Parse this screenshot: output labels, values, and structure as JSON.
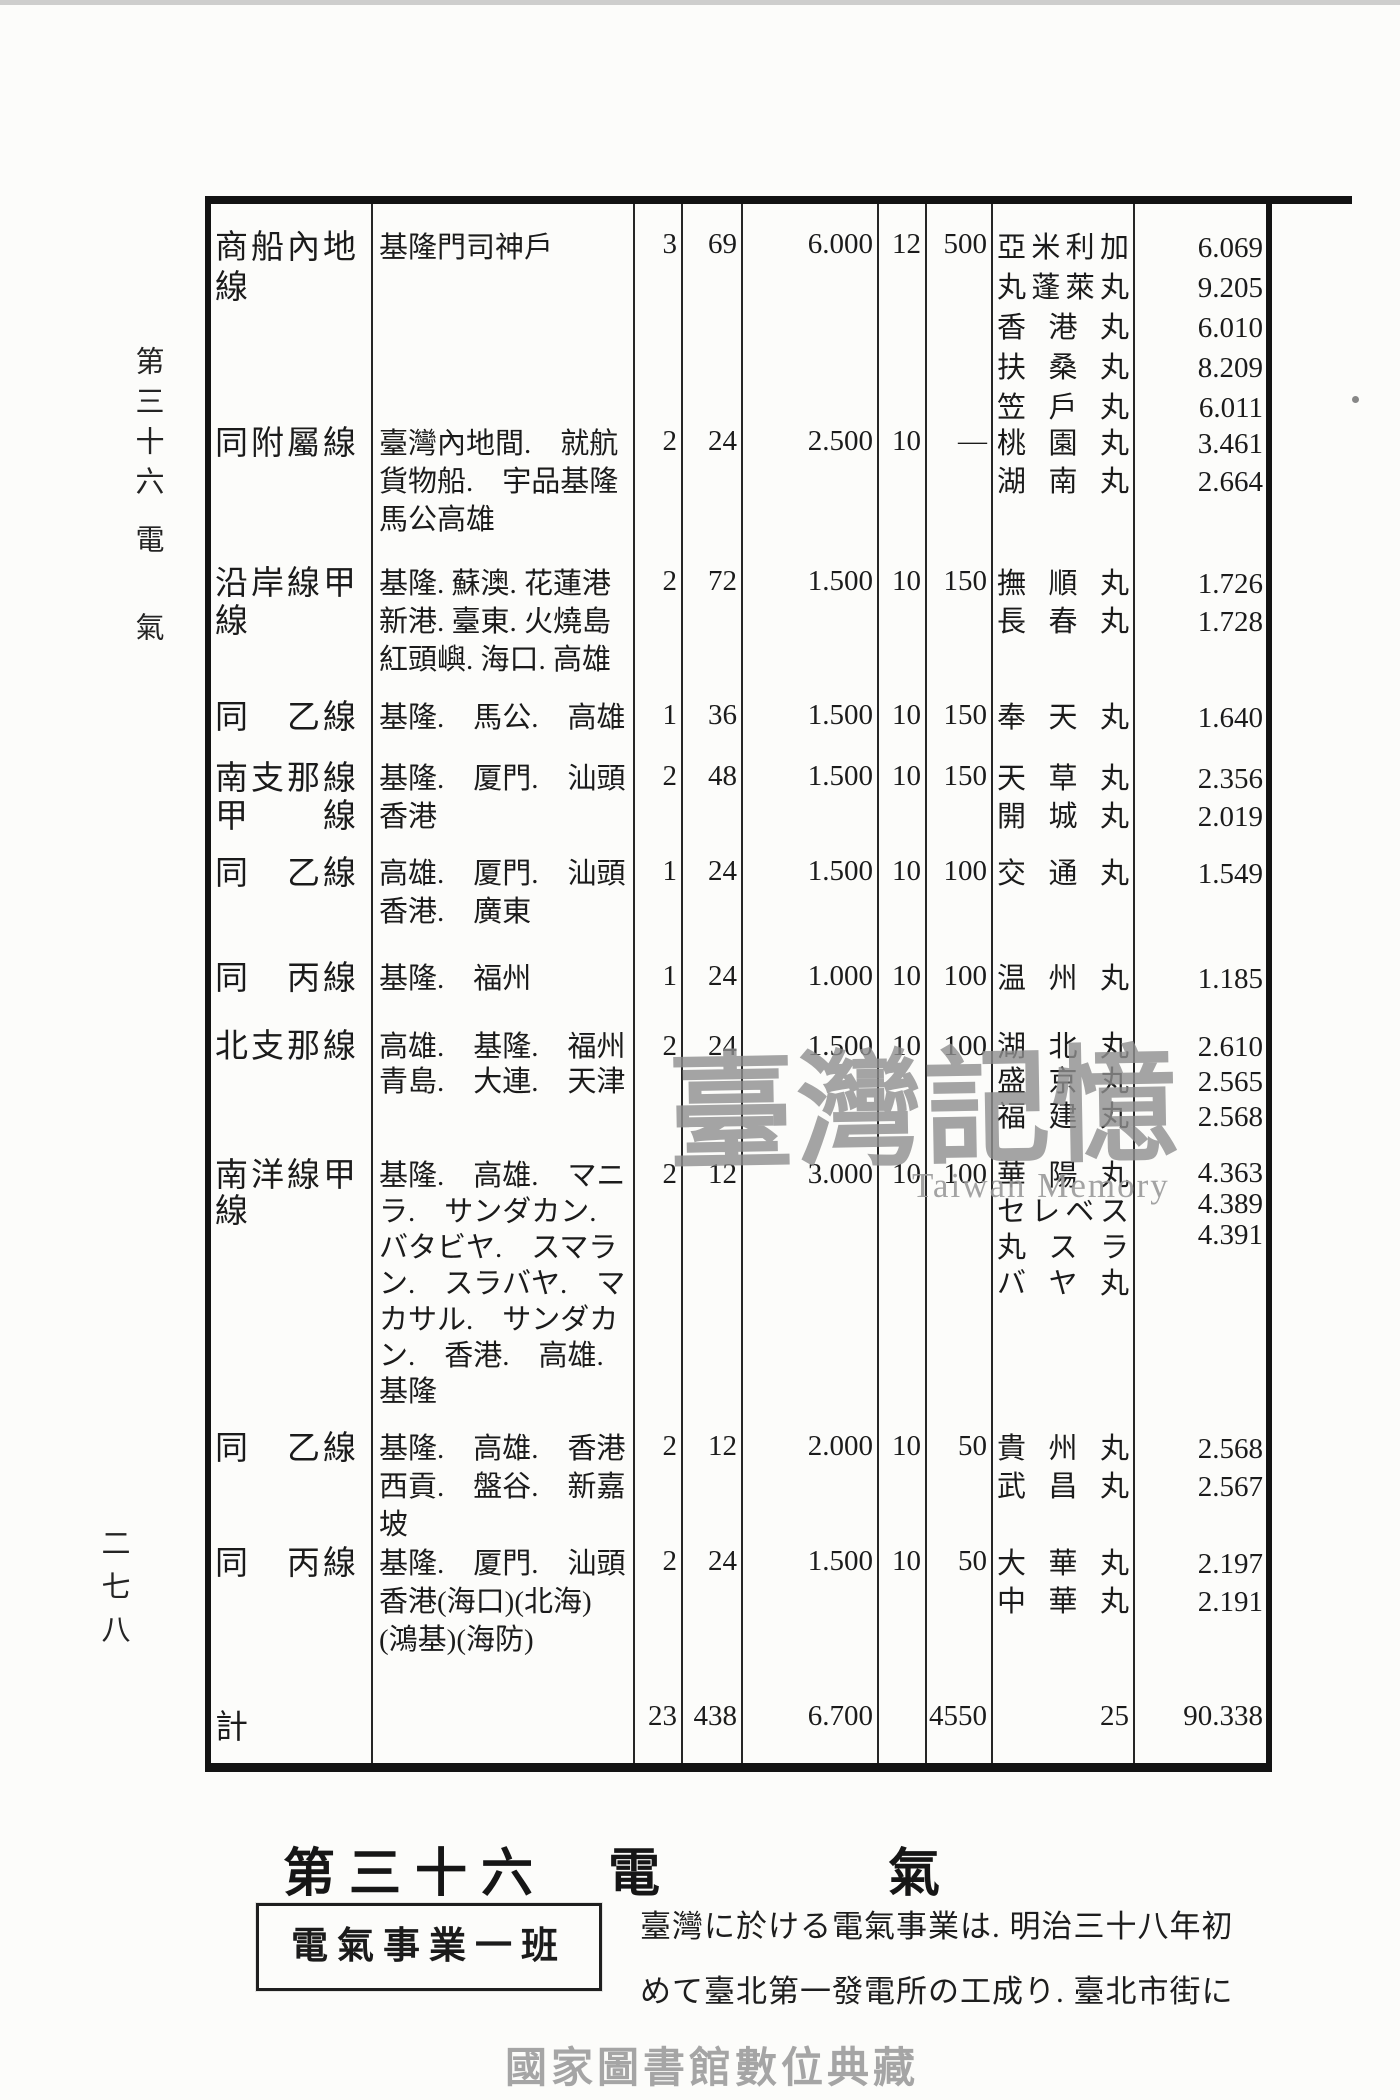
{
  "page": {
    "margin_chapter_top": "第三十六",
    "margin_chapter_mid": "電",
    "margin_chapter_bottom": "氣",
    "margin_page_number": "二七八",
    "heading": {
      "part1": "第三十六",
      "part2": "電",
      "part3": "氣"
    },
    "label_box": "電氣事業一班",
    "paragraph_line1": "臺灣に於ける電氣事業は. 明治三十八年初",
    "paragraph_line2": "めて臺北第一發電所の工成り. 臺北市街に",
    "watermark_script": "臺灣記憶",
    "watermark_latin": "Taiwan Memory",
    "footer_watermark": "國家圖書館數位典藏"
  },
  "colors": {
    "ink": "#1b1b1b",
    "table_border": "#131313",
    "watermark_gray": "#8f8f8f",
    "footer_gray": "#a5a5a5"
  },
  "table": {
    "rows": [
      {
        "name": [
          "商船內地",
          "線"
        ],
        "route": [
          "基隆門司神戶"
        ],
        "n": [
          "3",
          "69",
          "6.000",
          "12",
          "500"
        ],
        "ships": [
          "亞米利加",
          "丸蓬萊丸",
          "香港丸",
          "扶桑丸",
          "笠戶丸"
        ],
        "tons": [
          "6.069",
          "9.205",
          "6.010",
          "8.209",
          "6.011"
        ]
      },
      {
        "name": [
          "同附屬線"
        ],
        "route": [
          "臺灣內地間.　就航",
          "貨物船.　宇品基隆",
          "馬公高雄"
        ],
        "n": [
          "2",
          "24",
          "2.500",
          "10",
          "—"
        ],
        "ships": [
          "桃園丸",
          "湖南丸"
        ],
        "tons": [
          "3.461",
          "2.664"
        ]
      },
      {
        "name": [
          "沿岸線甲",
          "線"
        ],
        "route": [
          "基隆. 蘇澳. 花蓮港",
          "新港. 臺東. 火燒島",
          "紅頭嶼. 海口. 高雄"
        ],
        "n": [
          "2",
          "72",
          "1.500",
          "10",
          "150"
        ],
        "ships": [
          "撫順丸",
          "長春丸"
        ],
        "tons": [
          "1.726",
          "1.728"
        ]
      },
      {
        "name": [
          "同　乙線"
        ],
        "route": [
          "基隆.　馬公.　高雄"
        ],
        "n": [
          "1",
          "36",
          "1.500",
          "10",
          "150"
        ],
        "ships": [
          "奉天丸"
        ],
        "tons": [
          "1.640"
        ]
      },
      {
        "name": [
          "南支那線",
          "甲　　線"
        ],
        "route": [
          "基隆.　厦門.　汕頭",
          "香港"
        ],
        "n": [
          "2",
          "48",
          "1.500",
          "10",
          "150"
        ],
        "ships": [
          "天草丸",
          "開城丸"
        ],
        "tons": [
          "2.356",
          "2.019"
        ]
      },
      {
        "name": [
          "同　乙線"
        ],
        "route": [
          "高雄.　厦門.　汕頭",
          "香港.　廣東"
        ],
        "n": [
          "1",
          "24",
          "1.500",
          "10",
          "100"
        ],
        "ships": [
          "交通丸"
        ],
        "tons": [
          "1.549"
        ]
      },
      {
        "name": [
          "同　丙線"
        ],
        "route": [
          "基隆.　福州"
        ],
        "n": [
          "1",
          "24",
          "1.000",
          "10",
          "100"
        ],
        "ships": [
          "温州丸"
        ],
        "tons": [
          "1.185"
        ]
      },
      {
        "name": [
          "北支那線"
        ],
        "route": [
          "高雄.　基隆.　福州",
          "青島.　大連.　天津"
        ],
        "n": [
          "2",
          "24",
          "1.500",
          "10",
          "100"
        ],
        "ships": [
          "湖北丸",
          "盛京丸",
          "福建丸"
        ],
        "tons": [
          "2.610",
          "2.565",
          "2.568"
        ]
      },
      {
        "name": [
          "南洋線甲",
          "線"
        ],
        "route": [
          "基隆.　高雄.　マニ",
          "ラ.　サンダカン.",
          "バタビヤ.　スマラ",
          "ン.　スラバヤ.　マ",
          "カサル.　サンダカ",
          "ン.　香港.　高雄.",
          "基隆"
        ],
        "n": [
          "2",
          "12",
          "3.000",
          "10",
          "100"
        ],
        "ships": [
          "華陽丸",
          "セレベス",
          "丸スラ",
          "バヤ丸"
        ],
        "tons": [
          "4.363",
          "4.389",
          "4.391"
        ]
      },
      {
        "name": [
          "同　乙線"
        ],
        "route": [
          "基隆.　高雄.　香港",
          "西貢.　盤谷.　新嘉",
          "坡"
        ],
        "n": [
          "2",
          "12",
          "2.000",
          "10",
          "50"
        ],
        "ships": [
          "貴州丸",
          "武昌丸"
        ],
        "tons": [
          "2.568",
          "2.567"
        ]
      },
      {
        "name": [
          "同　丙線"
        ],
        "route": [
          "基隆.　厦門.　汕頭",
          "香港(海口)(北海)",
          "(鴻基)(海防)"
        ],
        "n": [
          "2",
          "24",
          "1.500",
          "10",
          "50"
        ],
        "ships": [
          "大華丸",
          "中華丸"
        ],
        "tons": [
          "2.197",
          "2.191"
        ]
      }
    ],
    "total": {
      "name": "計",
      "n": [
        "23",
        "438",
        "6.700",
        "",
        "4550"
      ],
      "ships_count": "25",
      "tonnage": "90.338"
    }
  }
}
